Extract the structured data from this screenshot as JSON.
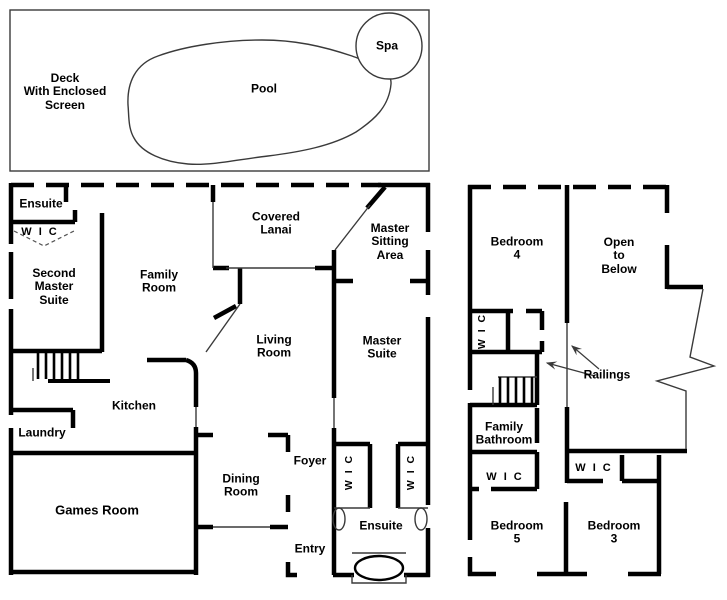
{
  "title": "Two-storey house floor plan",
  "outdoor": {
    "deck": "Deck\nWith Enclosed\nScreen",
    "pool": "Pool",
    "spa": "Spa"
  },
  "first_floor": {
    "ensuite_top": "Ensuite",
    "wic_top": "W I C",
    "second_master_suite": "Second\nMaster\nSuite",
    "family_room": "Family\nRoom",
    "covered_lanai": "Covered\nLanai",
    "master_sitting_area": "Master\nSitting\nArea",
    "living_room": "Living\nRoom",
    "master_suite": "Master\nSuite",
    "kitchen": "Kitchen",
    "laundry": "Laundry",
    "games_room": "Games Room",
    "dining_room": "Dining\nRoom",
    "foyer": "Foyer",
    "entry": "Entry",
    "wic_master_left": "W I C",
    "wic_master_right": "W I C",
    "ensuite_bottom": "Ensuite"
  },
  "second_floor": {
    "bedroom4": "Bedroom\n4",
    "open_to_below": "Open\nto\nBelow",
    "wic_bedroom4": "W I C",
    "railings": "Railings",
    "family_bathroom": "Family\nBathroom",
    "wic_bathroom": "W I C",
    "wic_bedroom3": "W I C",
    "bedroom5": "Bedroom\n5",
    "bedroom3": "Bedroom\n3"
  },
  "colors": {
    "wall": "#000000",
    "thin_line": "#3a3a3a",
    "background": "#ffffff"
  }
}
